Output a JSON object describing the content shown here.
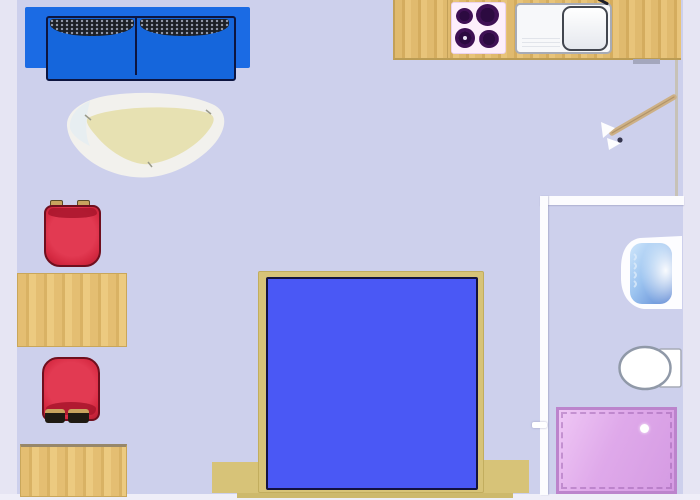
{
  "image_type": "floor-plan",
  "colors": {
    "floor": "#cdd0ec",
    "exterior": "#e6e5f3",
    "exterior-light": "#efeef8",
    "wall-white": "#fcfcfe",
    "wall-tan": "#c6bfae",
    "sofa-body": "#1b6be4",
    "sofa-seat": "#1566dc",
    "sofa-border": "#0d1540",
    "pillow": "#1d2026",
    "chair-red": "#d62a42",
    "chair-border": "#6f0f1e",
    "wood": "#ddb76a",
    "bed-frame": "#d7c378",
    "mattress": "#4a58f5",
    "mattress-border": "#13123f",
    "stove-top": "#fdeffb",
    "burner": "#3f1054",
    "shower-pink": "#dfa9ea",
    "shower-border": "#bc84cc",
    "rug-outer": "#f2f1ed",
    "rug-inner": "#e7e1b2",
    "door-wood": "#cdb086",
    "toilet-white": "#ffffff",
    "basin-blue": "#6b93dd"
  },
  "rooms": [
    {
      "name": "main-room",
      "contents": [
        "sofa",
        "area-rug",
        "dining-table-upper",
        "dining-chair-upper",
        "dining-chair-lower",
        "dining-table-lower",
        "double-bed"
      ]
    },
    {
      "name": "kitchenette",
      "contents": [
        "counter",
        "stove-top-4-burners",
        "kitchen-sink-with-drainboard"
      ]
    },
    {
      "name": "bathroom",
      "contents": [
        "wash-basin",
        "toilet",
        "shower-tray"
      ]
    }
  ],
  "furniture": {
    "sofa": {
      "type": "two-seat-sofa",
      "color": "#1b6be4",
      "cushions": 2
    },
    "area_rug": {
      "type": "rug",
      "color": "#e7e1b2"
    },
    "dining_tables": {
      "count": 2,
      "color": "#ddb76a"
    },
    "dining_chairs": {
      "count": 2,
      "color": "#d62a42"
    },
    "bed": {
      "type": "double-bed",
      "mattress_color": "#4a58f5",
      "frame_color": "#d7c378"
    },
    "stove": {
      "burners": 4,
      "burner_color": "#3f1054"
    },
    "kitchen_sink": {
      "basins": 1,
      "drainboard": true
    },
    "entry_door": {
      "state": "open",
      "swing": "inward",
      "wall": "right"
    },
    "bathroom_fixtures": {
      "wash_basin_color": "#6b93dd",
      "toilet_color": "#ffffff",
      "shower_color": "#dfa9ea"
    }
  }
}
